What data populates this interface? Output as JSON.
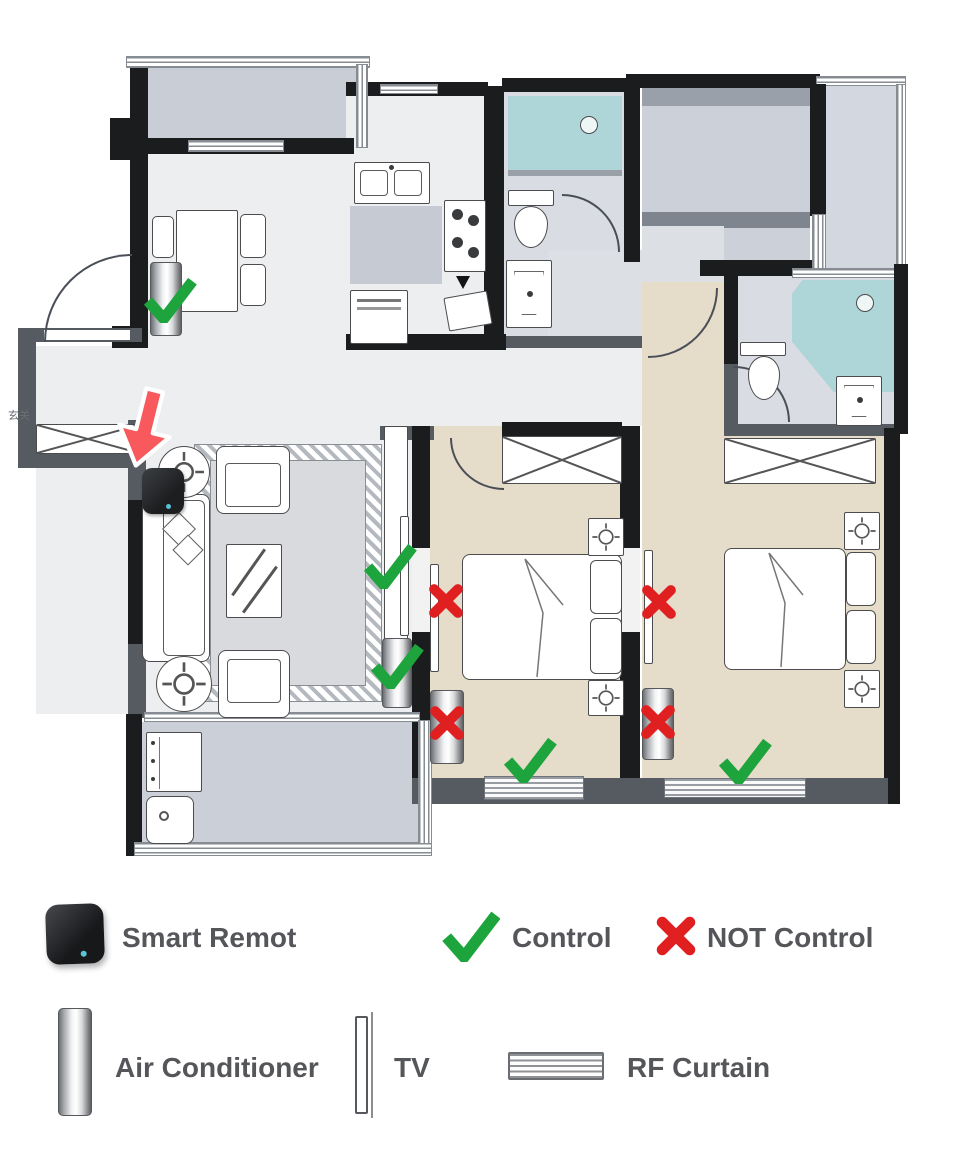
{
  "legend": {
    "row1": [
      {
        "icon": "smart-remote",
        "label": "Smart Remot"
      },
      {
        "icon": "green-check",
        "label": "Control"
      },
      {
        "icon": "red-x",
        "label": "NOT Control"
      }
    ],
    "row2": [
      {
        "icon": "air-conditioner",
        "label": "Air Conditioner"
      },
      {
        "icon": "tv",
        "label": "TV"
      },
      {
        "icon": "rf-curtain",
        "label": "RF Curtain"
      }
    ]
  },
  "floorplan": {
    "entry_label": "玄关",
    "smart_remote": {
      "room": "living-room",
      "pointed_by": "red-arrow"
    },
    "markers": [
      {
        "device": "air-conditioner",
        "room": "dining-area",
        "status": "control"
      },
      {
        "device": "tv",
        "room": "living-room-wall",
        "status": "control"
      },
      {
        "device": "air-conditioner",
        "room": "living-room-wall",
        "status": "control"
      },
      {
        "device": "tv",
        "room": "bedroom-1",
        "status": "not-control"
      },
      {
        "device": "air-conditioner",
        "room": "bedroom-1",
        "status": "not-control"
      },
      {
        "device": "rf-curtain",
        "room": "bedroom-1-window",
        "status": "control"
      },
      {
        "device": "tv",
        "room": "bedroom-2",
        "status": "not-control"
      },
      {
        "device": "air-conditioner",
        "room": "bedroom-2",
        "status": "not-control"
      },
      {
        "device": "rf-curtain",
        "room": "bedroom-2-window",
        "status": "control"
      }
    ]
  },
  "colors": {
    "control_green": "#1EA43C",
    "not_control_red": "#E02020",
    "arrow_red": "#F7595C",
    "wall_black": "#1b1c1e",
    "wall_gray": "#565b62",
    "floor_light": "#edeef0",
    "floor_tan": "#e5dcc9",
    "floor_gray": "#cbcfd8",
    "shower_teal": "#aed5d7",
    "label_text": "#55565a"
  }
}
